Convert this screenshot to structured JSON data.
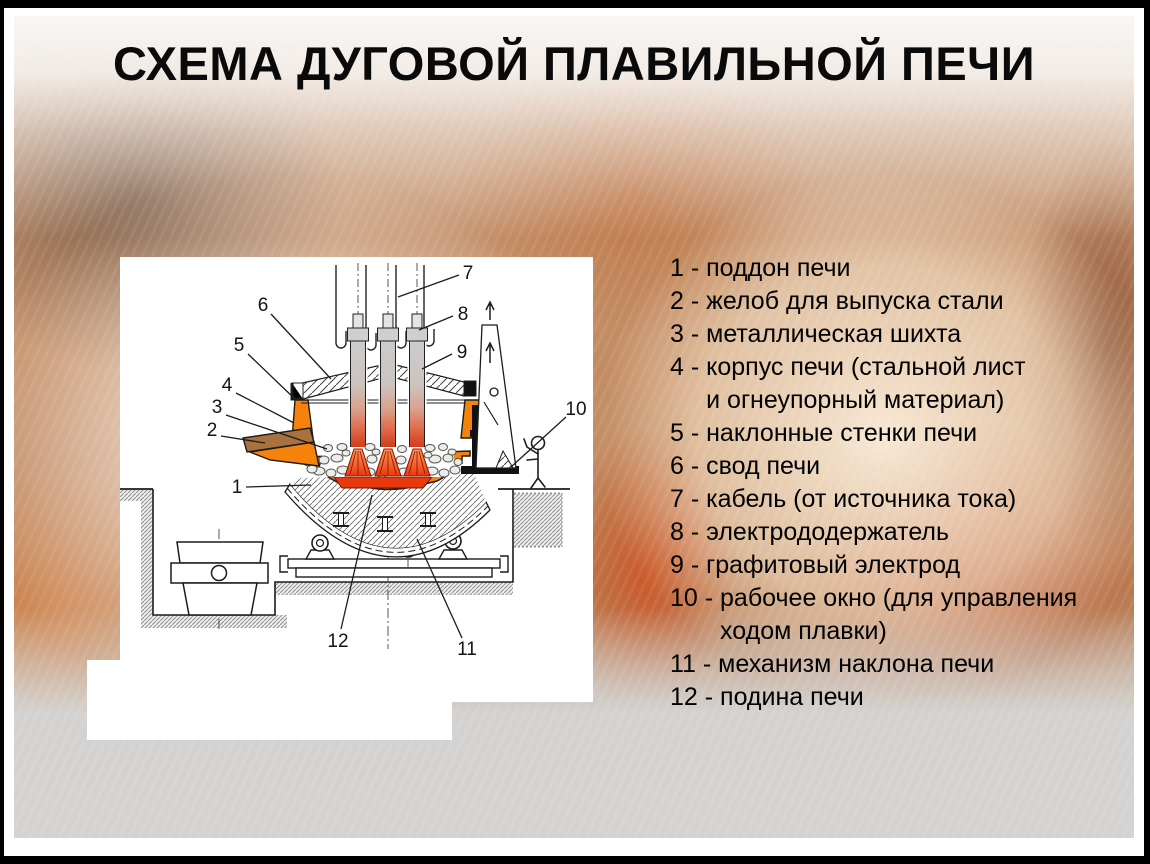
{
  "slide": {
    "title": "СХЕМА ДУГОВОЙ ПЛАВИЛЬНОЙ ПЕЧИ"
  },
  "legend": {
    "sep": "-",
    "items": [
      {
        "num": "1",
        "lines": [
          "поддон печи"
        ]
      },
      {
        "num": "2",
        "lines": [
          "желоб для выпуска стали"
        ]
      },
      {
        "num": "3",
        "lines": [
          "металлическая шихта"
        ]
      },
      {
        "num": "4",
        "lines": [
          "корпус печи (стальной лист",
          "и огнеупорный материал)"
        ]
      },
      {
        "num": "5",
        "lines": [
          "наклонные стенки печи"
        ]
      },
      {
        "num": "6",
        "lines": [
          "свод печи"
        ]
      },
      {
        "num": "7",
        "lines": [
          "кабель (от источника тока)"
        ]
      },
      {
        "num": "8",
        "lines": [
          "электрододержатель"
        ]
      },
      {
        "num": "9",
        "lines": [
          "графитовый электрод"
        ]
      },
      {
        "num": "10",
        "lines": [
          "рабочее окно (для управления",
          "ходом плавки)"
        ]
      },
      {
        "num": "11",
        "lines": [
          "механизм наклона печи"
        ]
      },
      {
        "num": "12",
        "lines": [
          "подина печи"
        ]
      }
    ]
  },
  "diagram": {
    "callouts": {
      "c1": "1",
      "c2": "2",
      "c3": "3",
      "c4": "4",
      "c5": "5",
      "c6": "6",
      "c7": "7",
      "c8": "8",
      "c9": "9",
      "c10": "10",
      "c11": "11",
      "c12": "12"
    }
  },
  "colors": {
    "furnace_orange": "#F5820B",
    "melt_red": "#E8380D",
    "chute_brown": "#A8713F",
    "window_yellow": "#F6E504",
    "line_black": "#1C1C1C",
    "panel_white": "#FFFFFF",
    "title_black": "#0A0A0A"
  }
}
